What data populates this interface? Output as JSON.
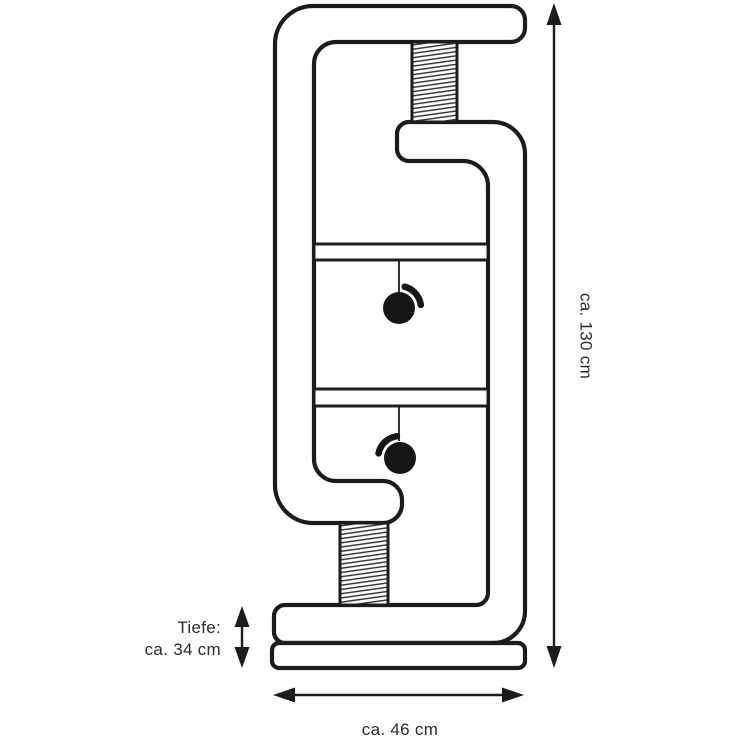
{
  "page": {
    "background": "#ffffff"
  },
  "diagram": {
    "kind": "product dimension drawing",
    "line_color": "#1c1c1c",
    "text_color": "#2b2b2b",
    "ball_color": "#161616",
    "labels": {
      "height": "ca. 130 cm",
      "depth_line1": "Tiefe:",
      "depth_line2": "ca. 34 cm",
      "width": "ca. 46 cm"
    }
  }
}
